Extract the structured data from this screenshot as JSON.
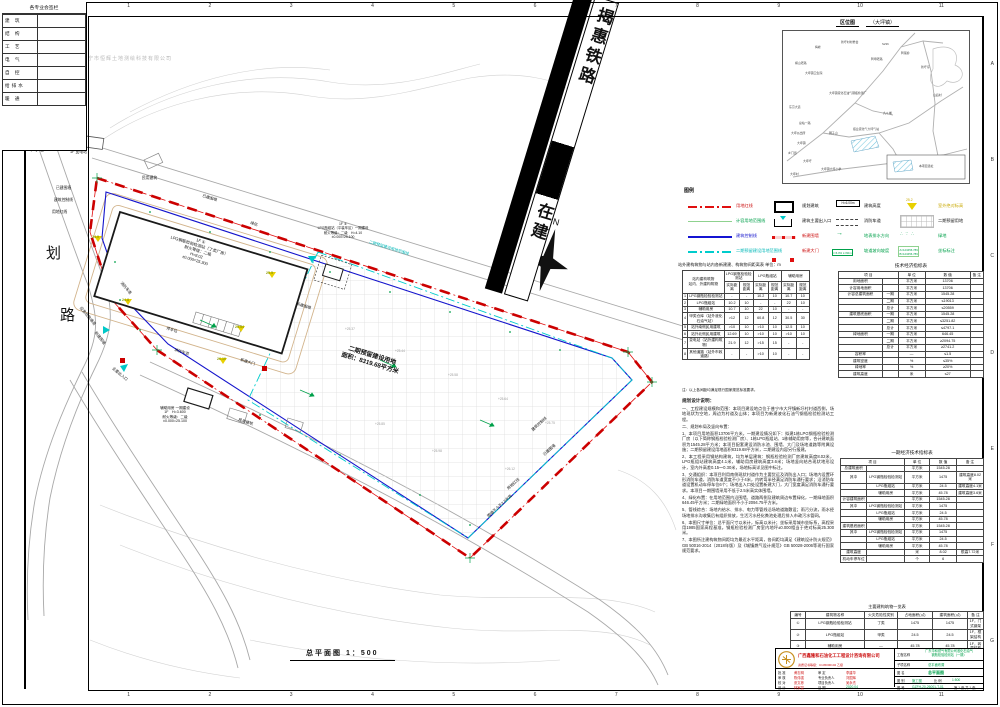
{
  "sheet": {
    "frame": {
      "cols": [
        "1",
        "2",
        "3",
        "4",
        "5",
        "6",
        "7",
        "8",
        "9",
        "10",
        "11"
      ],
      "rows": [
        "A",
        "B",
        "C",
        "D",
        "E",
        "F",
        "G"
      ]
    },
    "signature_panel": {
      "title": "各专业会签栏",
      "rows": [
        [
          "建 筑",
          ""
        ],
        [
          "结 构",
          ""
        ],
        [
          "工 艺",
          ""
        ],
        [
          "电 气",
          ""
        ],
        [
          "自 控",
          ""
        ],
        [
          "给排水",
          ""
        ],
        [
          "暖 通",
          ""
        ]
      ]
    },
    "watermark": "普宁市恒辉土地测绘科技有限公司",
    "scale_label": "总平面图 1：500"
  },
  "railway": {
    "name": "揭惠铁路",
    "status": "在建"
  },
  "north_label": "N",
  "location_map": {
    "title": "区位图",
    "subtitle": "（大坪镇）",
    "site_legend": "本项目选址",
    "labels": [
      {
        "text": "梅峰",
        "x": 32,
        "y": 14
      },
      {
        "text": "新圩村村委会",
        "x": 58,
        "y": 9
      },
      {
        "text": "横山老路",
        "x": 12,
        "y": 30
      },
      {
        "text": "大坪镇卫生院",
        "x": 22,
        "y": 40
      },
      {
        "text": "鸭母老路",
        "x": 88,
        "y": 26
      },
      {
        "text": "鸭尾岭",
        "x": 118,
        "y": 20
      },
      {
        "text": "新圩仔",
        "x": 138,
        "y": 34
      },
      {
        "text": "山后村",
        "x": 150,
        "y": 62
      },
      {
        "text": "S236",
        "x": 99,
        "y": 11
      },
      {
        "text": "大坪镇液化石油气钢瓶检测厂",
        "x": 46,
        "y": 60
      },
      {
        "text": "九斗埔",
        "x": 100,
        "y": 80
      },
      {
        "text": "振业液化气大坪气站",
        "x": 70,
        "y": 96
      },
      {
        "text": "东京大道",
        "x": 6,
        "y": 74
      },
      {
        "text": "总站一路",
        "x": 16,
        "y": 90
      },
      {
        "text": "大坪派出所",
        "x": 8,
        "y": 100
      },
      {
        "text": "大坪镇",
        "x": 14,
        "y": 110
      },
      {
        "text": "狮子山",
        "x": 46,
        "y": 100
      },
      {
        "text": "乡门街",
        "x": 5,
        "y": 120
      },
      {
        "text": "大坪圩",
        "x": 20,
        "y": 128
      },
      {
        "text": "大坪镇大坪小学",
        "x": 38,
        "y": 136
      },
      {
        "text": "大坪村",
        "x": 7,
        "y": 141
      }
    ]
  },
  "legend": {
    "title": "图例",
    "items": {
      "l1": {
        "label": "用地红线"
      },
      "l2": {
        "label": "计容用地范围线"
      },
      "l3": {
        "label": "建筑控制线"
      },
      "l4": {
        "label": "二期预留建设用地范围线"
      },
      "l5": {
        "label": "规划建筑"
      },
      "l6": {
        "label": "建筑主要出入口"
      },
      "l7": {
        "label": "新建围墙"
      },
      "l8": {
        "label": "新建大门"
      },
      "l9": {
        "label": "建筑高度",
        "swatch_text": "H=6.00m"
      },
      "l10": {
        "label": "消防车道",
        "swatch_text": "4m"
      },
      "l11": {
        "label": "地表排水方向",
        "swatch_text": "→"
      },
      "l12": {
        "label": "坡道坡向坡度",
        "swatch_text": "i=6.0% L=60m"
      },
      "l13": {
        "label": "室外绝对标高",
        "swatch_text": "25.2"
      },
      "l14": {
        "label": "二期预留用地"
      },
      "l15": {
        "label": "绿地",
        "swatch_text": "∴ ∵ ∴"
      },
      "l16": {
        "label": "坐标标注",
        "swatch_text": "A=123456.789\nB=123456.789"
      }
    }
  },
  "plan": {
    "labels": {
      "road1": "规",
      "road2": "划",
      "road3": "路",
      "substation": "1F 变电站",
      "wall_old_1": "已建围墙",
      "ctrl_line_1": "建筑控制线",
      "red_line_1": "用地红线",
      "civil_1": "民用建筑",
      "wall_old_2": "已建围墙",
      "green_1": "绿化",
      "phase2_line": "二期预留建设用地范围线",
      "fire_lane_1": "消防车道",
      "fire_lane_2": "消防车道",
      "wall_new_1": "新建围墙",
      "evac": "应急疏散通道",
      "entrance_main": "主要出入口",
      "gate_new": "新建大门",
      "parking": "停车位",
      "b1": "1F ①\nLPG钢瓶检验检测站（丁类厂房）\n耐火等级：二级\nH=8.02\n±0.000=25.300",
      "b2": "1F ②\nLPG瓶组站（平装车区）一期建设\n耐火等级：二级　H=4.10\n±0.000=25.100",
      "b3": "辅助用房 一期建设\n1F　H=3.600\n耐火等级：二级\n±0.000=25.100",
      "phase2": "二期预留建设用地\n面积：8319.68平方米",
      "ctrl_line_2": "建筑控制线",
      "wall_old_3": "已建围墙",
      "red_line_2": "用地红线",
      "wall_25": "围墙不少于2.5米高",
      "civil_2": "民用建筑",
      "wall_new_2": "新建围墙"
    },
    "spots": [
      "+25.37",
      "+25.44",
      "+25.58",
      "+25.64",
      "+25.75",
      "+25.85",
      "+25.98",
      "+26.12"
    ],
    "elev": [
      {
        "v": "24.9",
        "x": 94,
        "y": 236
      },
      {
        "v": "24.8",
        "x": 124,
        "y": 299
      },
      {
        "v": "25.5",
        "x": 268,
        "y": 272
      },
      {
        "v": "25.54",
        "x": 237,
        "y": 326
      },
      {
        "v": "26.10",
        "x": 219,
        "y": 358
      }
    ]
  },
  "distance_table": {
    "title": "站外建构筑物与站内各新建建、构筑物间距离表  单位：m",
    "corner_top": "站内建构筑物",
    "corner_bottom": "站内、外建构筑物",
    "groups": [
      "LPG钢瓶检验检测站",
      "LPG瓶组站",
      "辅助用房"
    ],
    "sub": [
      "实际距离",
      "规范距离"
    ],
    "rows": [
      [
        "1",
        "LPG钢瓶检验检测站",
        "-",
        "-",
        "10.2",
        "10",
        "10.7",
        "10"
      ],
      [
        "2",
        "LPG瓶组站",
        "10.2",
        "10",
        "-",
        "-",
        "22",
        "10"
      ],
      [
        "3",
        "辅助用房",
        "10.7",
        "10",
        "22",
        "10",
        "-",
        "-"
      ],
      [
        "4",
        "甲类仓库（站外液化石油气站）",
        ">12",
        "12",
        "60.8",
        "12",
        "30.5",
        "30"
      ],
      [
        "5",
        "站外南侧民用建筑",
        ">10",
        "10",
        ">10",
        "10",
        "12.5",
        "10"
      ],
      [
        "6",
        "站外北侧民用建筑",
        "12.69",
        "10",
        ">10",
        "10",
        ">10",
        "10"
      ],
      [
        "7",
        "变电站（站外建构筑物）",
        "21.9",
        "12",
        ">15",
        "15",
        "-",
        "-"
      ],
      [
        "8",
        "其他道路（站外市政道路）",
        "-",
        "-",
        ">10",
        "10",
        "-",
        "-"
      ]
    ],
    "note": "注：以上各间距均满足现行国家规范标准要求。"
  },
  "tech_table": {
    "title": "技术经济指标表",
    "header": [
      "项 目",
      "单 位",
      "数 值",
      "备 注"
    ],
    "rows": [
      [
        "用地面积",
        "",
        "平方米",
        "13706",
        ""
      ],
      [
        "计容用地面积",
        "",
        "平方米",
        "13706",
        ""
      ],
      [
        "计容总建筑面积",
        "一期",
        "平方米",
        "1545.28",
        ""
      ],
      [
        "",
        "二期",
        "平方米",
        "≤19013",
        ""
      ],
      [
        "",
        "总计",
        "平方米",
        "≤20559",
        ""
      ],
      [
        "建筑基底面积",
        "一期",
        "平方米",
        "1545.28",
        ""
      ],
      [
        "",
        "二期",
        "平方米",
        "≤3251.82",
        ""
      ],
      [
        "",
        "总计",
        "平方米",
        "≤4797.1",
        ""
      ],
      [
        "绿地面积",
        "一期",
        "平方米",
        "646.45",
        ""
      ],
      [
        "",
        "二期",
        "平方米",
        "≥2094.75",
        ""
      ],
      [
        "",
        "总计",
        "平方米",
        "≥2741.2",
        ""
      ],
      [
        "容积率",
        "",
        "—",
        "≤1.5",
        ""
      ],
      [
        "建筑密度",
        "",
        "%",
        "≤35%",
        ""
      ],
      [
        "绿地率",
        "",
        "%",
        "≥20%",
        ""
      ],
      [
        "建筑高度",
        "",
        "米",
        "≤27",
        ""
      ]
    ]
  },
  "phase1_table": {
    "title": "一期经济技术指标表",
    "header": [
      "项 目",
      "单 位",
      "数 值",
      "备 注"
    ],
    "rows": [
      [
        "总建筑面积",
        "",
        "平方米",
        "1545.28",
        ""
      ],
      [
        "其中",
        "LPG钢瓶检验检测站",
        "平方米",
        "1475",
        "建筑高度8.02米"
      ],
      [
        "",
        "LPG瓶组站",
        "平方米",
        "24.5",
        "建筑高度4.1米"
      ],
      [
        "",
        "辅助用房",
        "平方米",
        "45.78",
        "建筑高度3.6米"
      ],
      [
        "计容建筑面积",
        "",
        "平方米",
        "1545.28",
        ""
      ],
      [
        "其中",
        "LPG钢瓶检验检测站",
        "平方米",
        "1475",
        ""
      ],
      [
        "",
        "LPG瓶组站",
        "平方米",
        "24.5",
        ""
      ],
      [
        "",
        "辅助用房",
        "平方米",
        "45.78",
        ""
      ],
      [
        "建筑基底面积",
        "",
        "平方米",
        "1545.28",
        ""
      ],
      [
        "其中",
        "LPG钢瓶检验检测站",
        "平方米",
        "1475",
        ""
      ],
      [
        "",
        "LPG瓶组站",
        "平方米",
        "24.5",
        ""
      ],
      [
        "",
        "辅助用房",
        "平方米",
        "45.78",
        ""
      ],
      [
        "建筑高度",
        "",
        "米",
        "8.02",
        "檐高7.72米"
      ],
      [
        "机动车停车位",
        "",
        "个",
        "6",
        ""
      ]
    ]
  },
  "buildings_table": {
    "title": "主要建构筑物一览表",
    "header": [
      "编号",
      "建筑物名称",
      "火灾危险性类别",
      "占地面积(㎡)",
      "建筑面积(㎡)",
      "备 注"
    ],
    "rows": [
      [
        "①",
        "LPG钢瓶检验检测站",
        "丁类",
        "1475",
        "1475",
        "1F，门式钢架"
      ],
      [
        "②",
        "LPG瓶组站",
        "甲类",
        "24.5",
        "24.5",
        "1F，框架结构"
      ],
      [
        "③",
        "辅助用房",
        "—",
        "45.78",
        "45.78",
        "1F，砖混结构"
      ]
    ]
  },
  "notes": {
    "title": "规划设计说明：",
    "paragraphs": [
      "一、工程建设规模和范围：本项目建设地点位于普宁市大坪镇新圩村村道西侧，场地现状为空地，周边为村道及山体；本项目为新建液化石油气钢瓶检验检测站工程。",
      "二、规划布局及竖向布置：",
      "1、本项目用地面积13706平方米，一期建设情况如下：拟建1栋LPG钢瓶检验检测厂房（以下简称钢瓶检验检测厂房）、1栋LPG瓶组站、1栋辅助用房等，合计建筑面积为1545.28平方米；本项目配套建设消防水池、围墙、大门及场地道路等附属设施；二期预留建设用地面积8319.68平方米，二期建设内容另行报建。",
      "2、本工程采用钢结构建筑，均为单层建筑：钢瓶检验检测厂房建筑高度8.02米，LPG瓶组站建筑高度4.1米，辅助用房建筑高度3.6米；场地竖向结合现状地形设计，室内外高差0.15～0.30米，场地标高详见图中标注。",
      "3、交通组织：本项目利用南侧现状村道作为主要货运及消防出入口；场地内设置环形消防车道，消防车道宽度不小于4米，内转弯半径满足消防车通行要求；沿消防车道设置机动车停车位6个；场地出入口处设置新建大门，大门宽度满足消防车通行要求。本项目一期围墙采用不低于2.5米高实体围墙。",
      "4、绿化布置：在用地范围内沿围墙、道路两侧及建筑周边布置绿化，一期绿地面积646.45平方米；二期绿地面积不小于2094.75平方米。",
      "5、管线综合：场地内给水、排水、电力等管线沿场地道路敷设；雨污分流，雨水经场地排水沟收集后有组织排放，生活污水经化粪池处理后排入市政污水管网。",
      "6、本图尺寸单位：总平面尺寸以米计，标高以米计；坐标采用城市坐标系，高程采用1985国家高程基准。钢瓶检验检测厂房室内地坪±0.000相当于绝对标高25.300米。",
      "7、本图所注建构筑物间距均为最近水平距离，各间距均满足《建筑设计防火规范》GB 50016-2014（2018年版）及《城镇燃气设计规范》GB 50028-2006等现行国家规范要求。"
    ]
  },
  "title_block": {
    "company": "广西鑫隆和石油化工工程设计咨询有限公司",
    "cert": "资质证书等级：C145000102 乙级",
    "roles": {
      "r1l": "批 准",
      "r1ln": "黄志明",
      "r1r": "审 定",
      "r1rn": "李建华",
      "r2l": "审 核",
      "r2ln": "陈伟强",
      "r2r": "专业负责人",
      "r2rn": "刘国辉",
      "r3l": "校 对",
      "r3ln": "张文彬",
      "r3r": "项目负责人",
      "r3rn": "吴永杰",
      "r4l": "设 计",
      "r4ln": "林家豪",
      "r4r": "日 期",
      "r4rn": "2020.04"
    },
    "fields": {
      "project_label": "工程名称",
      "project_value": "广东华和燃气有限公司液化石油气\n钢瓶检验检测站（一期）",
      "sub_label": "子项名称",
      "sub_value": "总平面布置",
      "drawing_label": "图 名",
      "drawing_value": "总平面图",
      "stage_label": "图 别",
      "stage_value": "施工图",
      "scale_label": "比 例",
      "scale_value": "1:500",
      "no_label": "图 号",
      "no_value": "GZFH-20-26001-T-01",
      "sheet_label": "第 1 张 共 1 张"
    }
  }
}
